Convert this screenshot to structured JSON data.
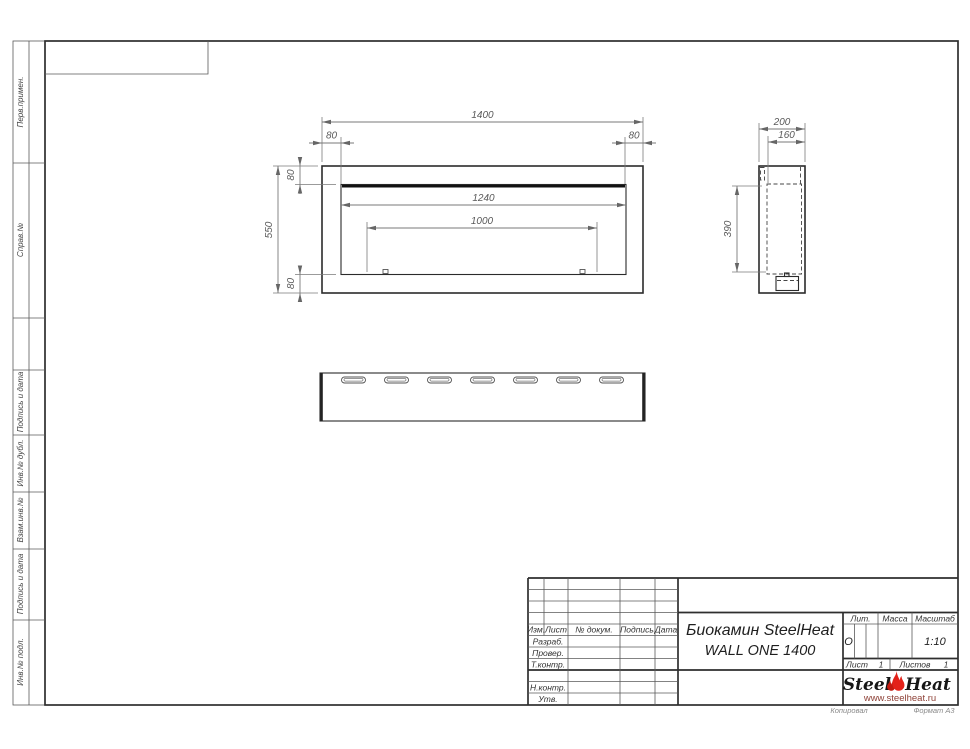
{
  "sheet": {
    "copied": "Копировал",
    "format": "Формат А3"
  },
  "margin_boxes": [
    {
      "label": "Перв.примен."
    },
    {
      "label": "Справ.№"
    },
    {
      "label": "Подпись и дата"
    },
    {
      "label": "Инв.№ дубл."
    },
    {
      "label": "Взам.инв.№"
    },
    {
      "label": "Подпись и дата"
    },
    {
      "label": "Инв.№ подл."
    }
  ],
  "views": {
    "front": {
      "width": "1400",
      "height": "550",
      "opening_width": "1240",
      "burner_spacing": "1000",
      "margin_top": "80",
      "margin_bottom": "80",
      "margin_left": "80",
      "margin_right": "80"
    },
    "side": {
      "depth": "200",
      "inner_depth": "160",
      "inner_height": "390"
    }
  },
  "title_block": {
    "cols": {
      "izm": "Изм.",
      "list": "Лист",
      "doc": "№ докум.",
      "sign": "Подпись",
      "date": "Дата"
    },
    "rows": {
      "razrab": "Разраб.",
      "prover": "Провер.",
      "tkontr": "Т.контр.",
      "nkontr": "Н.контр.",
      "utv": "Утв."
    },
    "name_line1": "Биокамин SteelHeat",
    "name_line2": "WALL ONE 1400",
    "lit_label": "Лит.",
    "lit_value": "О",
    "mass_label": "Масса",
    "scale_label": "Масштаб",
    "scale_value": "1:10",
    "sheet_label": "Лист",
    "sheet_value": "1",
    "sheets_label": "Листов",
    "sheets_value": "1"
  },
  "logo": {
    "steel": "Steel",
    "heat": "Heat",
    "url": "www.steelheat.ru",
    "flame_color": "#e32119",
    "flame_dark": "#c41a10"
  }
}
